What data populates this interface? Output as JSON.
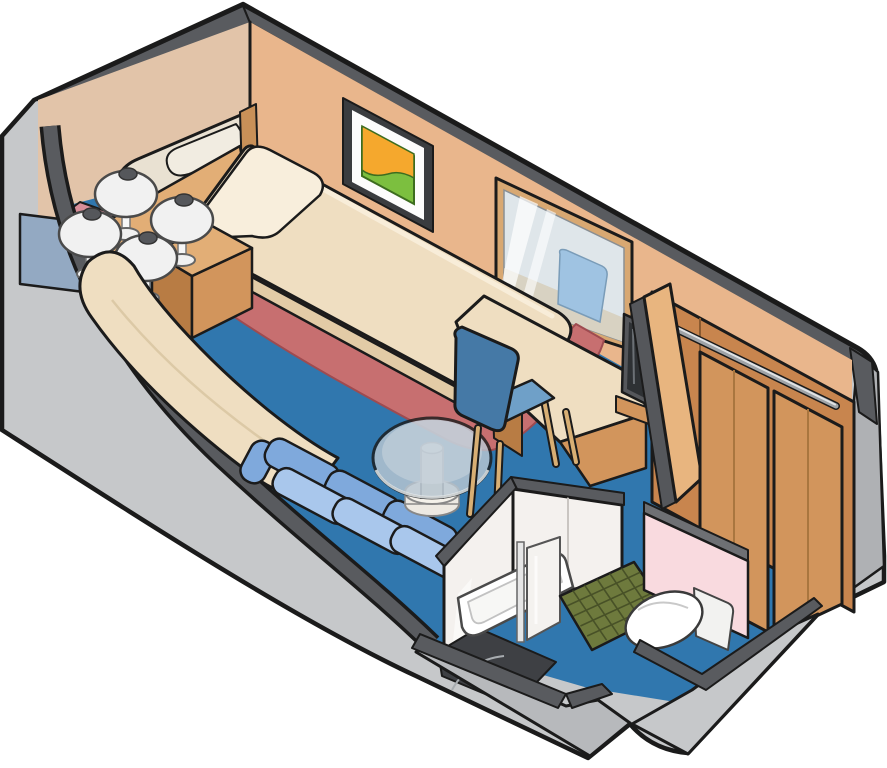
{
  "scene": {
    "kind": "isometric-cutaway-floorplan",
    "subject": "interior-stateroom-cabin",
    "items": [
      {
        "name": "twin-bed"
      },
      {
        "name": "main-bed"
      },
      {
        "name": "pillows"
      },
      {
        "name": "headboard-console"
      },
      {
        "name": "nightstand"
      },
      {
        "name": "mushroom-lamps",
        "count": 4
      },
      {
        "name": "wall-art-framed"
      },
      {
        "name": "wall-panel"
      },
      {
        "name": "carpet-runner"
      },
      {
        "name": "chaise-bench"
      },
      {
        "name": "sofa"
      },
      {
        "name": "coffee-table-glass"
      },
      {
        "name": "vanity-desk"
      },
      {
        "name": "mirror"
      },
      {
        "name": "tv"
      },
      {
        "name": "desk-chair"
      },
      {
        "name": "wardrobe-closet"
      },
      {
        "name": "hanging-rail"
      },
      {
        "name": "bathroom"
      },
      {
        "name": "shower-tray"
      },
      {
        "name": "shower-glass"
      },
      {
        "name": "bath-mat-tiled"
      },
      {
        "name": "toilet"
      },
      {
        "name": "entry-walls"
      }
    ]
  },
  "palette": {
    "outline": "#1B1B1B",
    "background": "#FFFFFF",
    "outerGray": "#C6C8CA",
    "outerGrayMid": "#B7B9BC",
    "outerGrayDark": "#AFB1B4",
    "capDark": "#595B5F",
    "wallPeach": "#E9B68C",
    "wallPeachLight": "#E2C4A9",
    "floorBlue": "#3077AE",
    "cream": "#EFDEC1",
    "creamShadow": "#E2CBA6",
    "creamHighlight": "#F8EEDC",
    "ivory": "#E9E1D2",
    "ivoryShadow": "#DBCFBA",
    "ivoryPillow": "#F1ECE1",
    "redRunner": "#C76F70",
    "redRunnerEdge": "#9E4B50",
    "rosePanel": "#D88E99",
    "bluePanel": "#93A9C2",
    "woodLight": "#E2AE76",
    "woodMid": "#D2955C",
    "woodDark": "#B87C44",
    "woodPale": "#E8B57F",
    "woodInterior": "#C8854E",
    "woodLine": "#A9763F",
    "headboardWood": "#C89058",
    "lampShade": "#F1F1F1",
    "lampCap": "#55575B",
    "lampStem": "#F6F6F6",
    "frameDark": "#3A3C3F",
    "matWhite": "#FCFCFC",
    "artOrange": "#F5A82D",
    "artGreen": "#7CBF3F",
    "mirrorFrame": "#D8A872",
    "mirrorGlass": "#DFE6EA",
    "mirrorStreak": "#FFFFFF",
    "reflectionDesk": "#D8D2C2",
    "reflectionChair": "#9FC3E2",
    "glassTop": "#B9C7D2",
    "glassInner": "#CDD8E0",
    "pedestal": "#EDE9E2",
    "chairBlue": "#4579A6",
    "chairSeat": "#6FA0C8",
    "legTan": "#D8AF74",
    "sofaBlue": "#7FA9DC",
    "sofaSeat": "#A9C7EC",
    "sofaBase": "#5E8BC8",
    "tvFrame": "#55575B",
    "tvScreen": "#2E3134",
    "railSilver": "#9FA3A7",
    "railHighlight": "#E8EAEC",
    "bathWhite": "#F4F1EE",
    "floorDark": "#3E4044",
    "matGreen": "#6E7A3D",
    "matGrid": "#3F4722",
    "toiletWhite": "#FFFFFF",
    "pinkWall": "#F9DADF",
    "pinkCap": "#6E7074"
  }
}
